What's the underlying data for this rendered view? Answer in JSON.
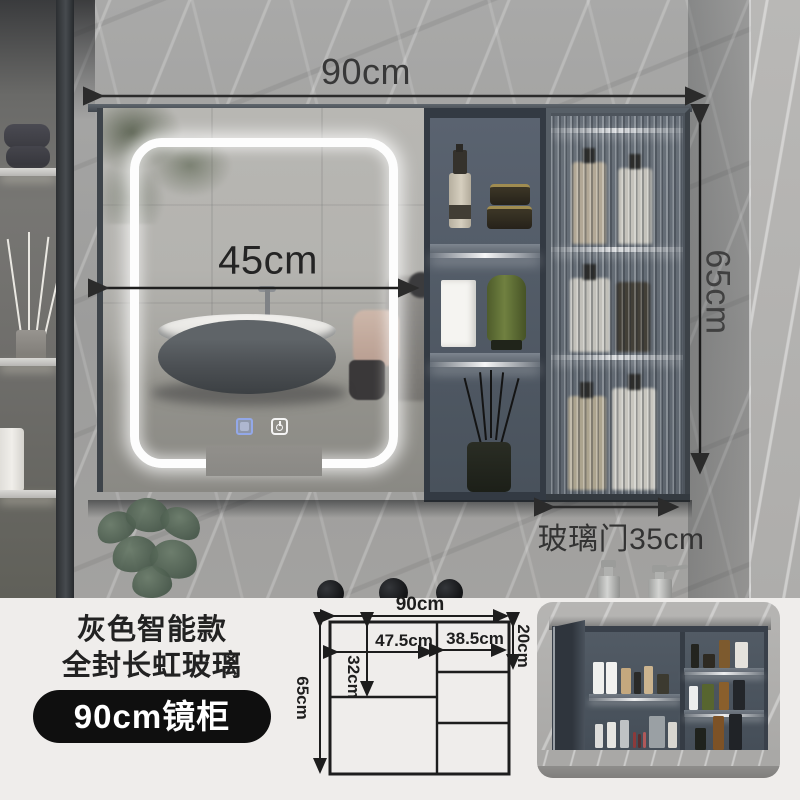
{
  "photo": {
    "dims": {
      "top_width": "90cm",
      "mirror_width": "45cm",
      "cabinet_height": "65cm",
      "glass_door_width": "玻璃门35cm"
    }
  },
  "info_panel": {
    "title_line1": "灰色智能款",
    "title_line2": "全封长虹玻璃",
    "badge_label": "90cm镜柜"
  },
  "diagram": {
    "overall_width": "90cm",
    "overall_height": "65cm",
    "mirror_section_width": "47.5cm",
    "door_section_width": "38.5cm",
    "top_shelf_height": "20cm",
    "upper_section_height": "32cm"
  },
  "colors": {
    "badge_background": "#0f0f0f",
    "annotation_text": "#383838",
    "dimension_line": "#2b2b2b",
    "cabinet_interior": "#4d5763",
    "led_light": "#ffffff",
    "panel_background": "#efedeb"
  }
}
